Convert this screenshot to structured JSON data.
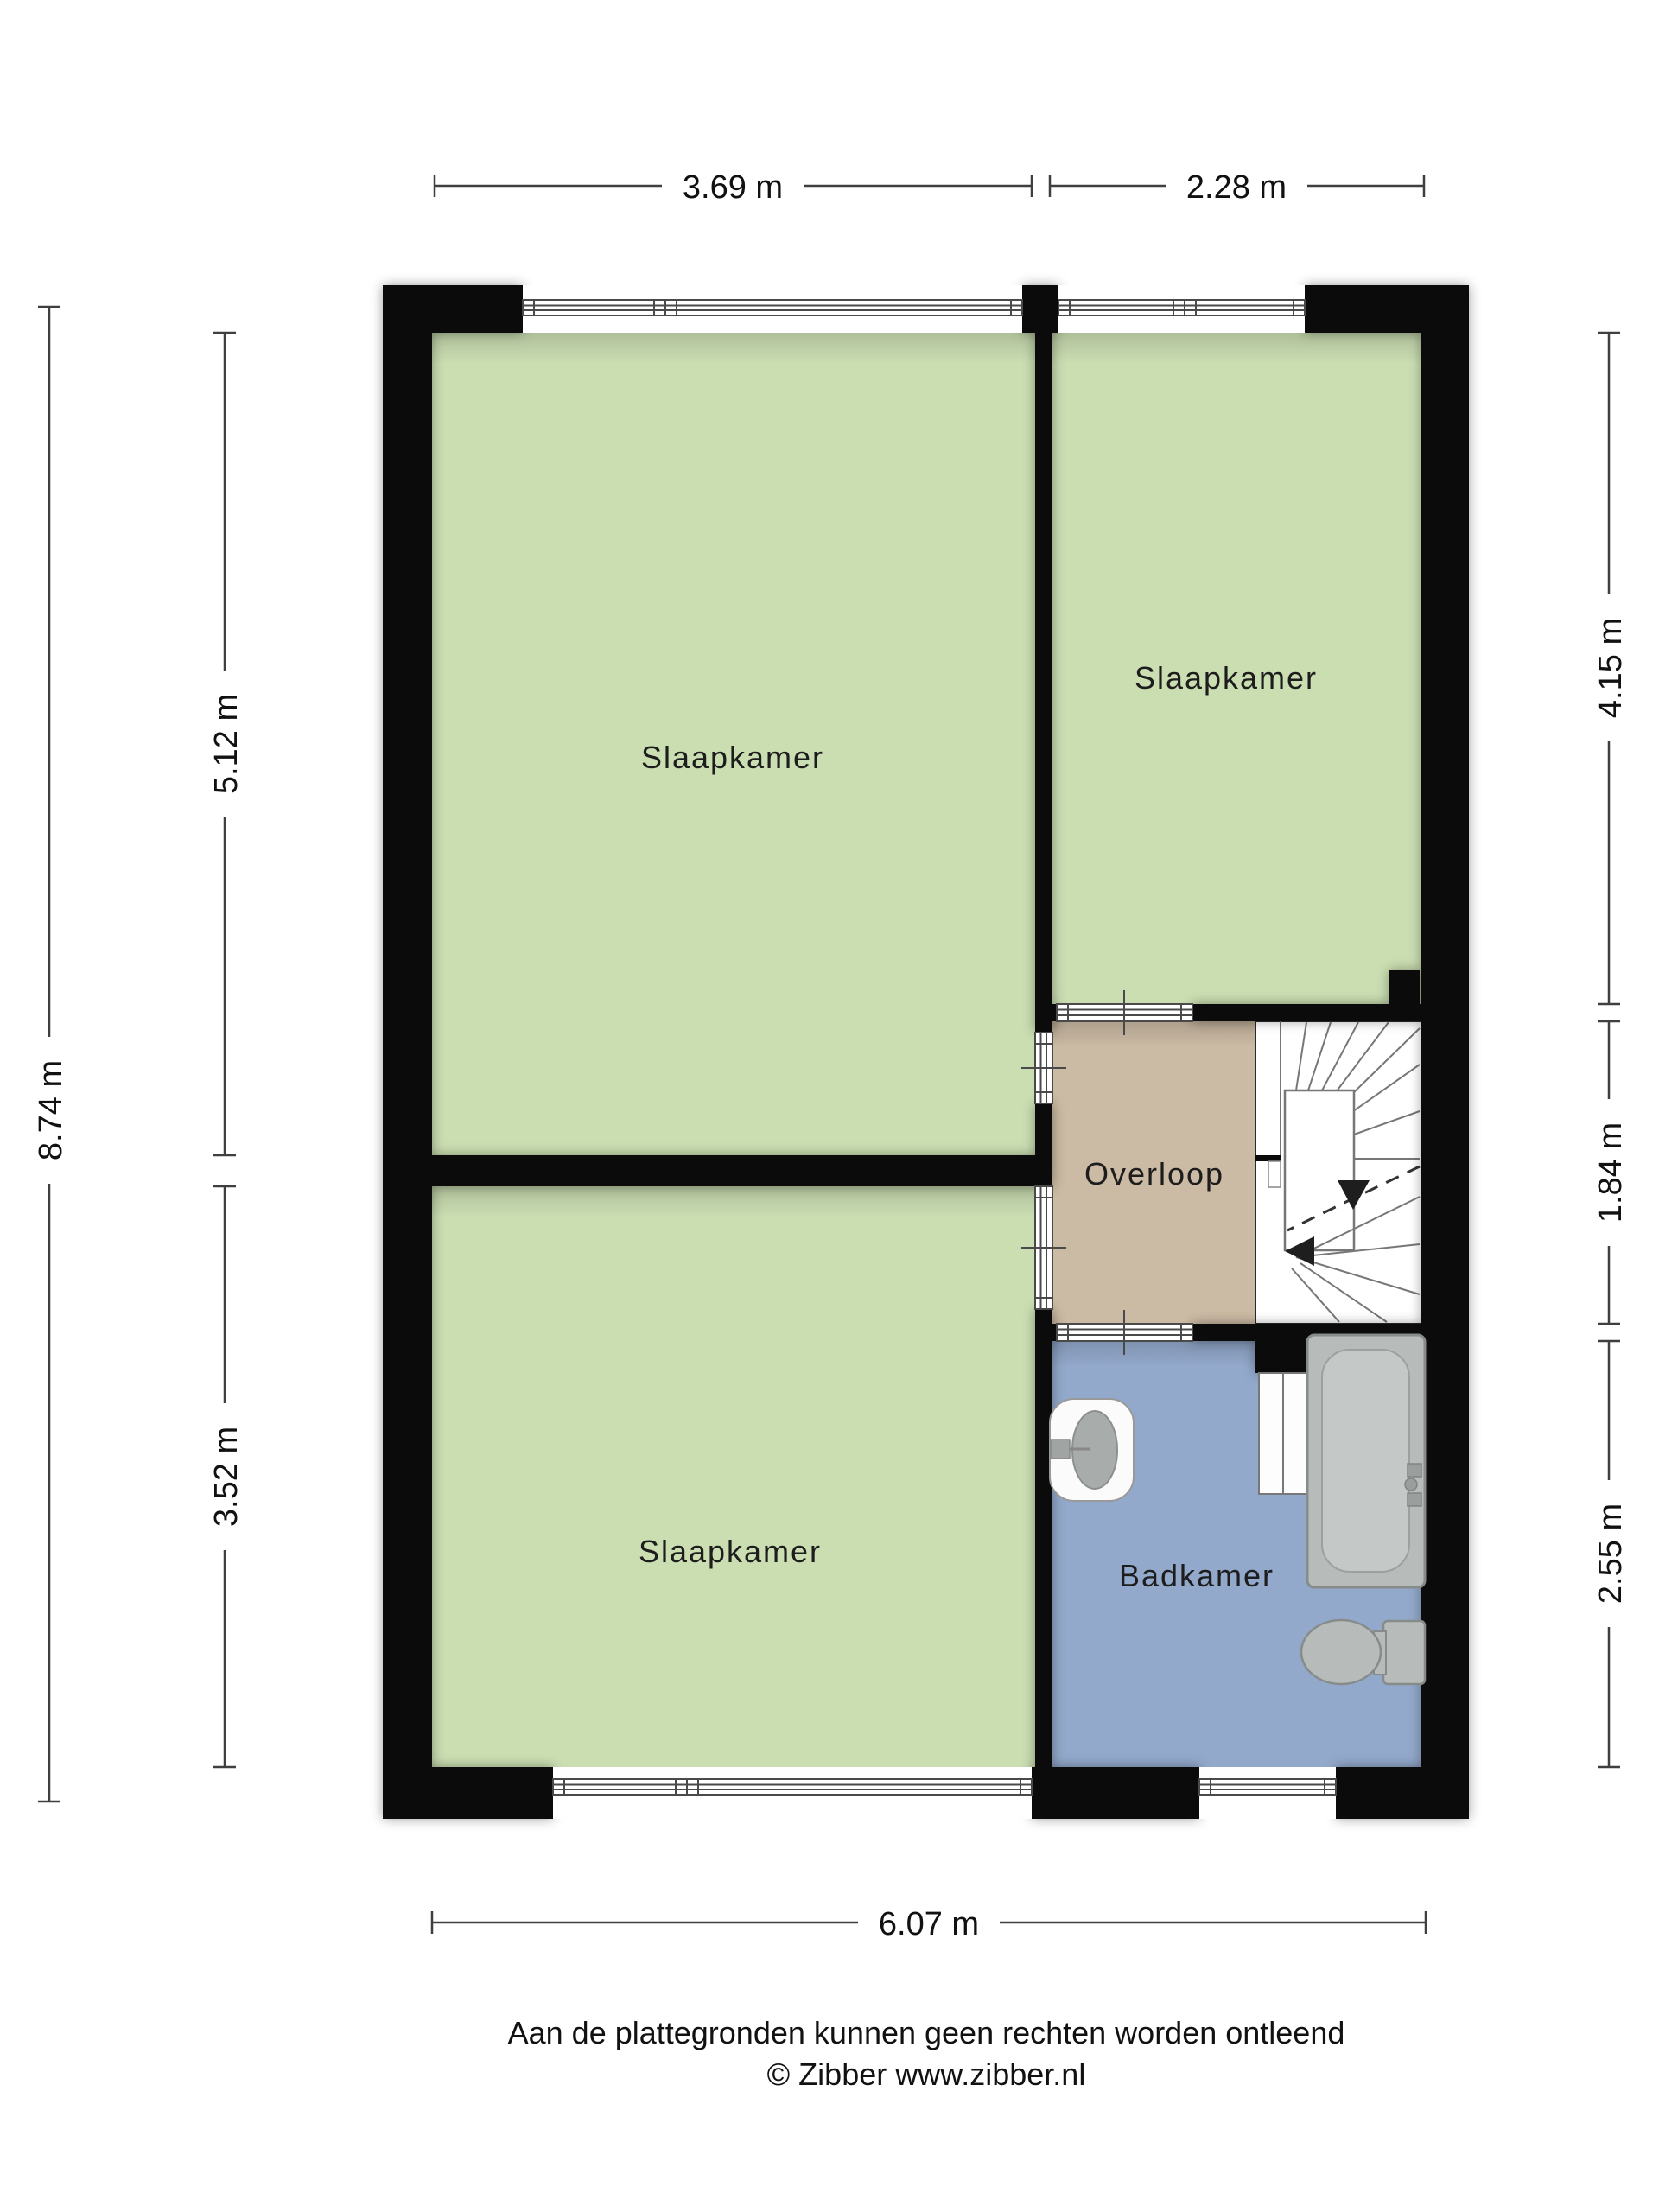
{
  "floorplan": {
    "rooms": [
      {
        "id": "bedroom-top-left",
        "label": "Slaapkamer"
      },
      {
        "id": "bedroom-top-right",
        "label": "Slaapkamer"
      },
      {
        "id": "bedroom-bottom-left",
        "label": "Slaapkamer"
      },
      {
        "id": "landing",
        "label": "Overloop"
      },
      {
        "id": "bathroom",
        "label": "Badkamer"
      }
    ],
    "colors": {
      "wall": "#0b0b0b",
      "bedroom_floor": "#cbdeb2",
      "landing_floor": "#cbbaa4",
      "bathroom_floor": "#93a9cb",
      "stair_floor": "#ffffff",
      "fixture_fill": "#b7bbb9",
      "fixture_inner": "#c4c8c6",
      "basin_fill": "#a8acaa",
      "dimension_line": "#3f3f3f"
    },
    "dimensions": {
      "top": [
        "3.69 m",
        "2.28 m"
      ],
      "bottom": [
        "6.07 m"
      ],
      "left": {
        "overall": "8.74 m",
        "segments": [
          "5.12 m",
          "3.52 m"
        ]
      },
      "right": [
        "4.15 m",
        "1.84 m",
        "2.55 m"
      ]
    },
    "fixtures": [
      "staircase",
      "bathtub",
      "sink",
      "toilet"
    ],
    "footer": {
      "disclaimer": "Aan de plattegronden kunnen geen rechten worden ontleend",
      "credit": "© Zibber www.zibber.nl"
    }
  }
}
